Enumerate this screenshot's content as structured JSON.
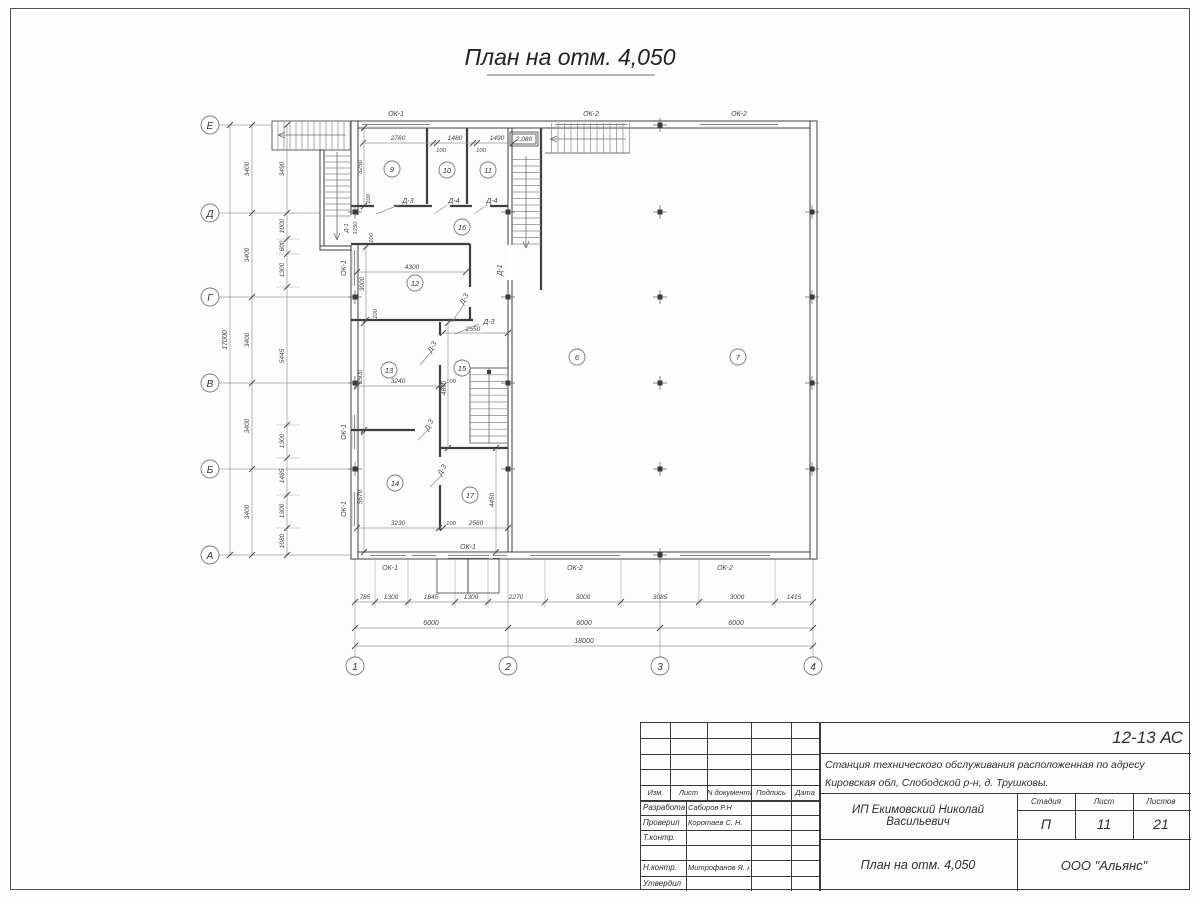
{
  "page": {
    "title": "План на отм. 4,050"
  },
  "axes": {
    "bottom": [
      "1",
      "2",
      "3",
      "4"
    ],
    "left": [
      "Е",
      "Д",
      "Г",
      "В",
      "Б",
      "А"
    ]
  },
  "dims": {
    "bottom_detail": [
      "785",
      "1300",
      "1845",
      "1300",
      "2270",
      "3000",
      "3085",
      "3000",
      "1415"
    ],
    "bottom_bays": [
      "6000",
      "6000",
      "6000"
    ],
    "bottom_total": "18000",
    "left_detail": [
      "3490",
      "1000",
      "600",
      "1300",
      "5445",
      "1300",
      "1485",
      "1300",
      "1080"
    ],
    "left_bays": [
      "3400",
      "3400",
      "3400",
      "3400",
      "3400"
    ],
    "left_total": "17000",
    "top_room": [
      "2760",
      "100",
      "1480",
      "100",
      "1490"
    ],
    "interior": {
      "v3250": "3250",
      "v1250": "1250",
      "v3000": "3000",
      "v3500": "3500",
      "v5670": "5670",
      "h4300": "4300",
      "h2550": "2550",
      "h3240": "3240",
      "v4890": "4890",
      "h3230": "3230",
      "h2560": "2560",
      "v4450": "4450",
      "gap100": "100"
    }
  },
  "rooms": {
    "r6": "6",
    "r7": "7",
    "r9": "9",
    "r10": "10",
    "r11": "11",
    "r12": "12",
    "r13": "13",
    "r14": "14",
    "r15": "15",
    "r16": "16",
    "r17": "17"
  },
  "marks": {
    "door1": "Д-1",
    "door3": "Д-3",
    "door4": "Д-4",
    "win1": "ОК-1",
    "win2": "ОК-2",
    "level": "2,080"
  },
  "title_block": {
    "doc_code": "12-13 АС",
    "project_line1": "Станция технического обслуживания расположенная по адресу",
    "project_line2": "Кировская обл, Слободской р-н, д. Трушковы.",
    "client": "ИП Екимовский Николай Васильевич",
    "sheet_title": "План на отм. 4,050",
    "company": "ООО \"Альянс\"",
    "stage_label": "Стадия",
    "stage": "П",
    "sheet_label": "Лист",
    "sheet": "11",
    "sheets_label": "Листов",
    "sheets": "21",
    "cols": {
      "izm": "Изм.",
      "list": "Лист",
      "ndoc": "N документа",
      "sign": "Подпись",
      "date": "Дата"
    },
    "rows": [
      {
        "role": "Разработал",
        "name": "Сабиров Р.Н"
      },
      {
        "role": "Проверил",
        "name": "Коротаев С. Н."
      },
      {
        "role": "Т.контр.",
        "name": ""
      },
      {
        "role": "",
        "name": ""
      },
      {
        "role": "Н.контр.",
        "name": "Митрофанов Я. А."
      },
      {
        "role": "Утвердил",
        "name": ""
      }
    ]
  }
}
